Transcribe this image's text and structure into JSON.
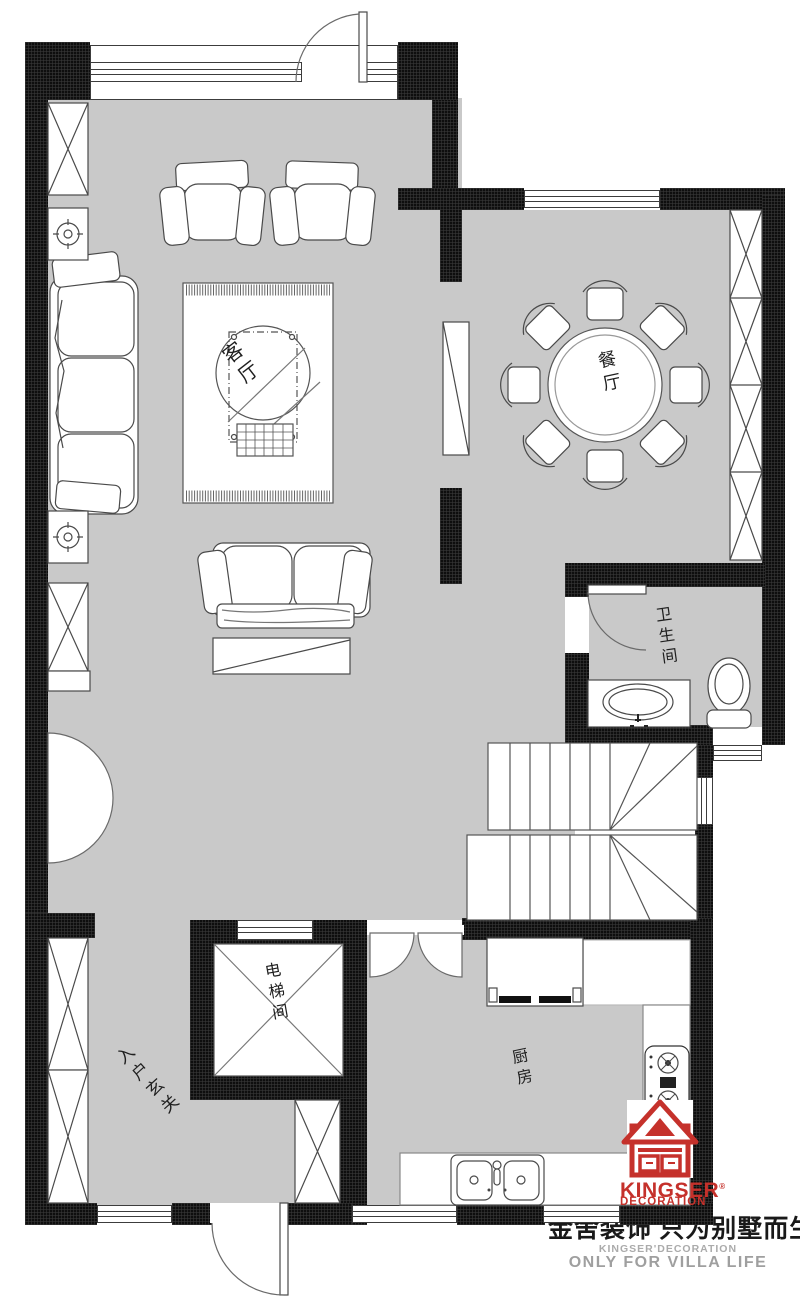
{
  "plan": {
    "rooms": {
      "living": "客厅",
      "dining": "餐厅",
      "bathroom": "卫生间",
      "elevator": "电梯间",
      "entrance": "入户玄关",
      "kitchen": "厨房"
    }
  },
  "branding": {
    "logo_word": "KINGSER",
    "logo_word_sub": "DECORATION",
    "registered_mark": "®",
    "slogan_cn": "金舍装饰 只为别墅而生。",
    "tagline_small": "KINGSER'DECORATION",
    "tagline": "ONLY FOR VILLA LIFE",
    "brand_red": "#c5312b"
  },
  "colors": {
    "floor_gray": "#c9c9c9",
    "wall_black": "#0e0e0e",
    "line_gray": "#4a4a4a"
  }
}
